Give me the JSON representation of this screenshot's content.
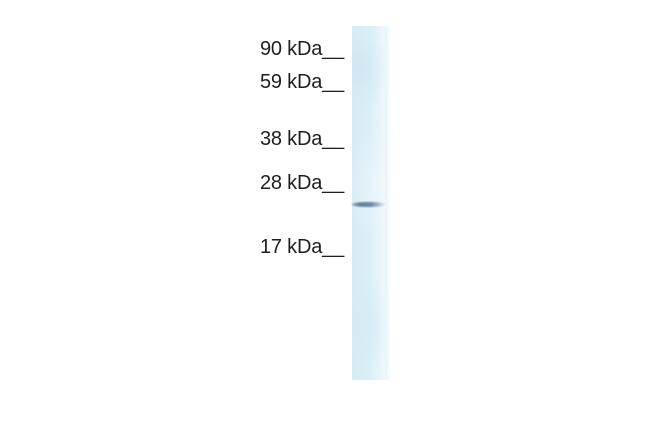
{
  "figure": {
    "type": "western-blot",
    "background_color": "#ffffff",
    "text_color": "#1e1e1e",
    "markers": [
      {
        "value": "90",
        "unit": "kDa",
        "label": "90 kDa__"
      },
      {
        "value": "59",
        "unit": "kDa",
        "label": "59 kDa__"
      },
      {
        "value": "38",
        "unit": "kDa",
        "label": "38 kDa__"
      },
      {
        "value": "28",
        "unit": "kDa",
        "label": "28 kDa__"
      },
      {
        "value": "17",
        "unit": "kDa",
        "label": "17 kDa__"
      }
    ],
    "lane": {
      "color": "#ddeff7",
      "band_color": "#5a7c96",
      "band_position": "just below 28 kDa mark"
    }
  }
}
